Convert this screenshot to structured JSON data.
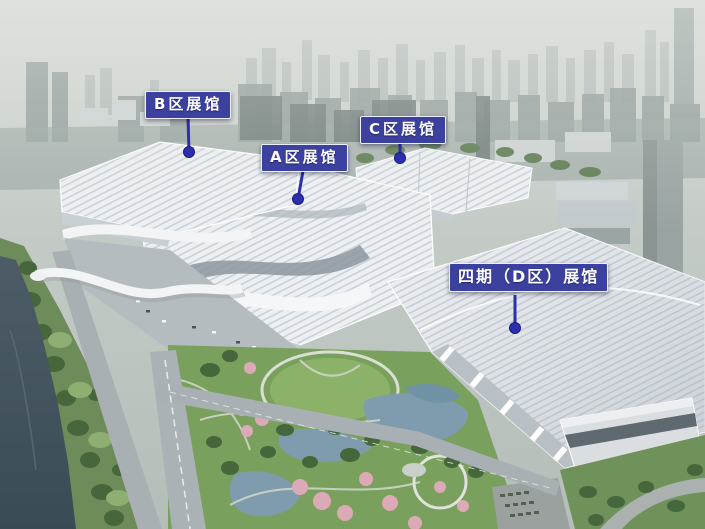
{
  "annotations": [
    {
      "id": "hall-b",
      "text": "B区展馆",
      "box": {
        "left": 145,
        "top": 91
      },
      "anchor": {
        "x": 188,
        "y": 117
      },
      "dot": {
        "x": 189,
        "y": 152
      }
    },
    {
      "id": "hall-a",
      "text": "A区展馆",
      "box": {
        "left": 261,
        "top": 144
      },
      "anchor": {
        "x": 303,
        "y": 171
      },
      "dot": {
        "x": 298,
        "y": 199
      }
    },
    {
      "id": "hall-c",
      "text": "C区展馆",
      "box": {
        "left": 360,
        "top": 116
      },
      "anchor": {
        "x": 400,
        "y": 142
      },
      "dot": {
        "x": 400,
        "y": 158
      }
    },
    {
      "id": "hall-d",
      "text": "四期（D区）展馆",
      "box": {
        "left": 449,
        "top": 263
      },
      "anchor": {
        "x": 515,
        "y": 295
      },
      "dot": {
        "x": 515,
        "y": 328
      }
    }
  ],
  "colors": {
    "annotation_bg": "#3c41a0",
    "annotation_border": "#eceefb",
    "annotation_text": "#ffffff",
    "connector": "#2b2fae",
    "dot_edge": "#191d7d"
  }
}
